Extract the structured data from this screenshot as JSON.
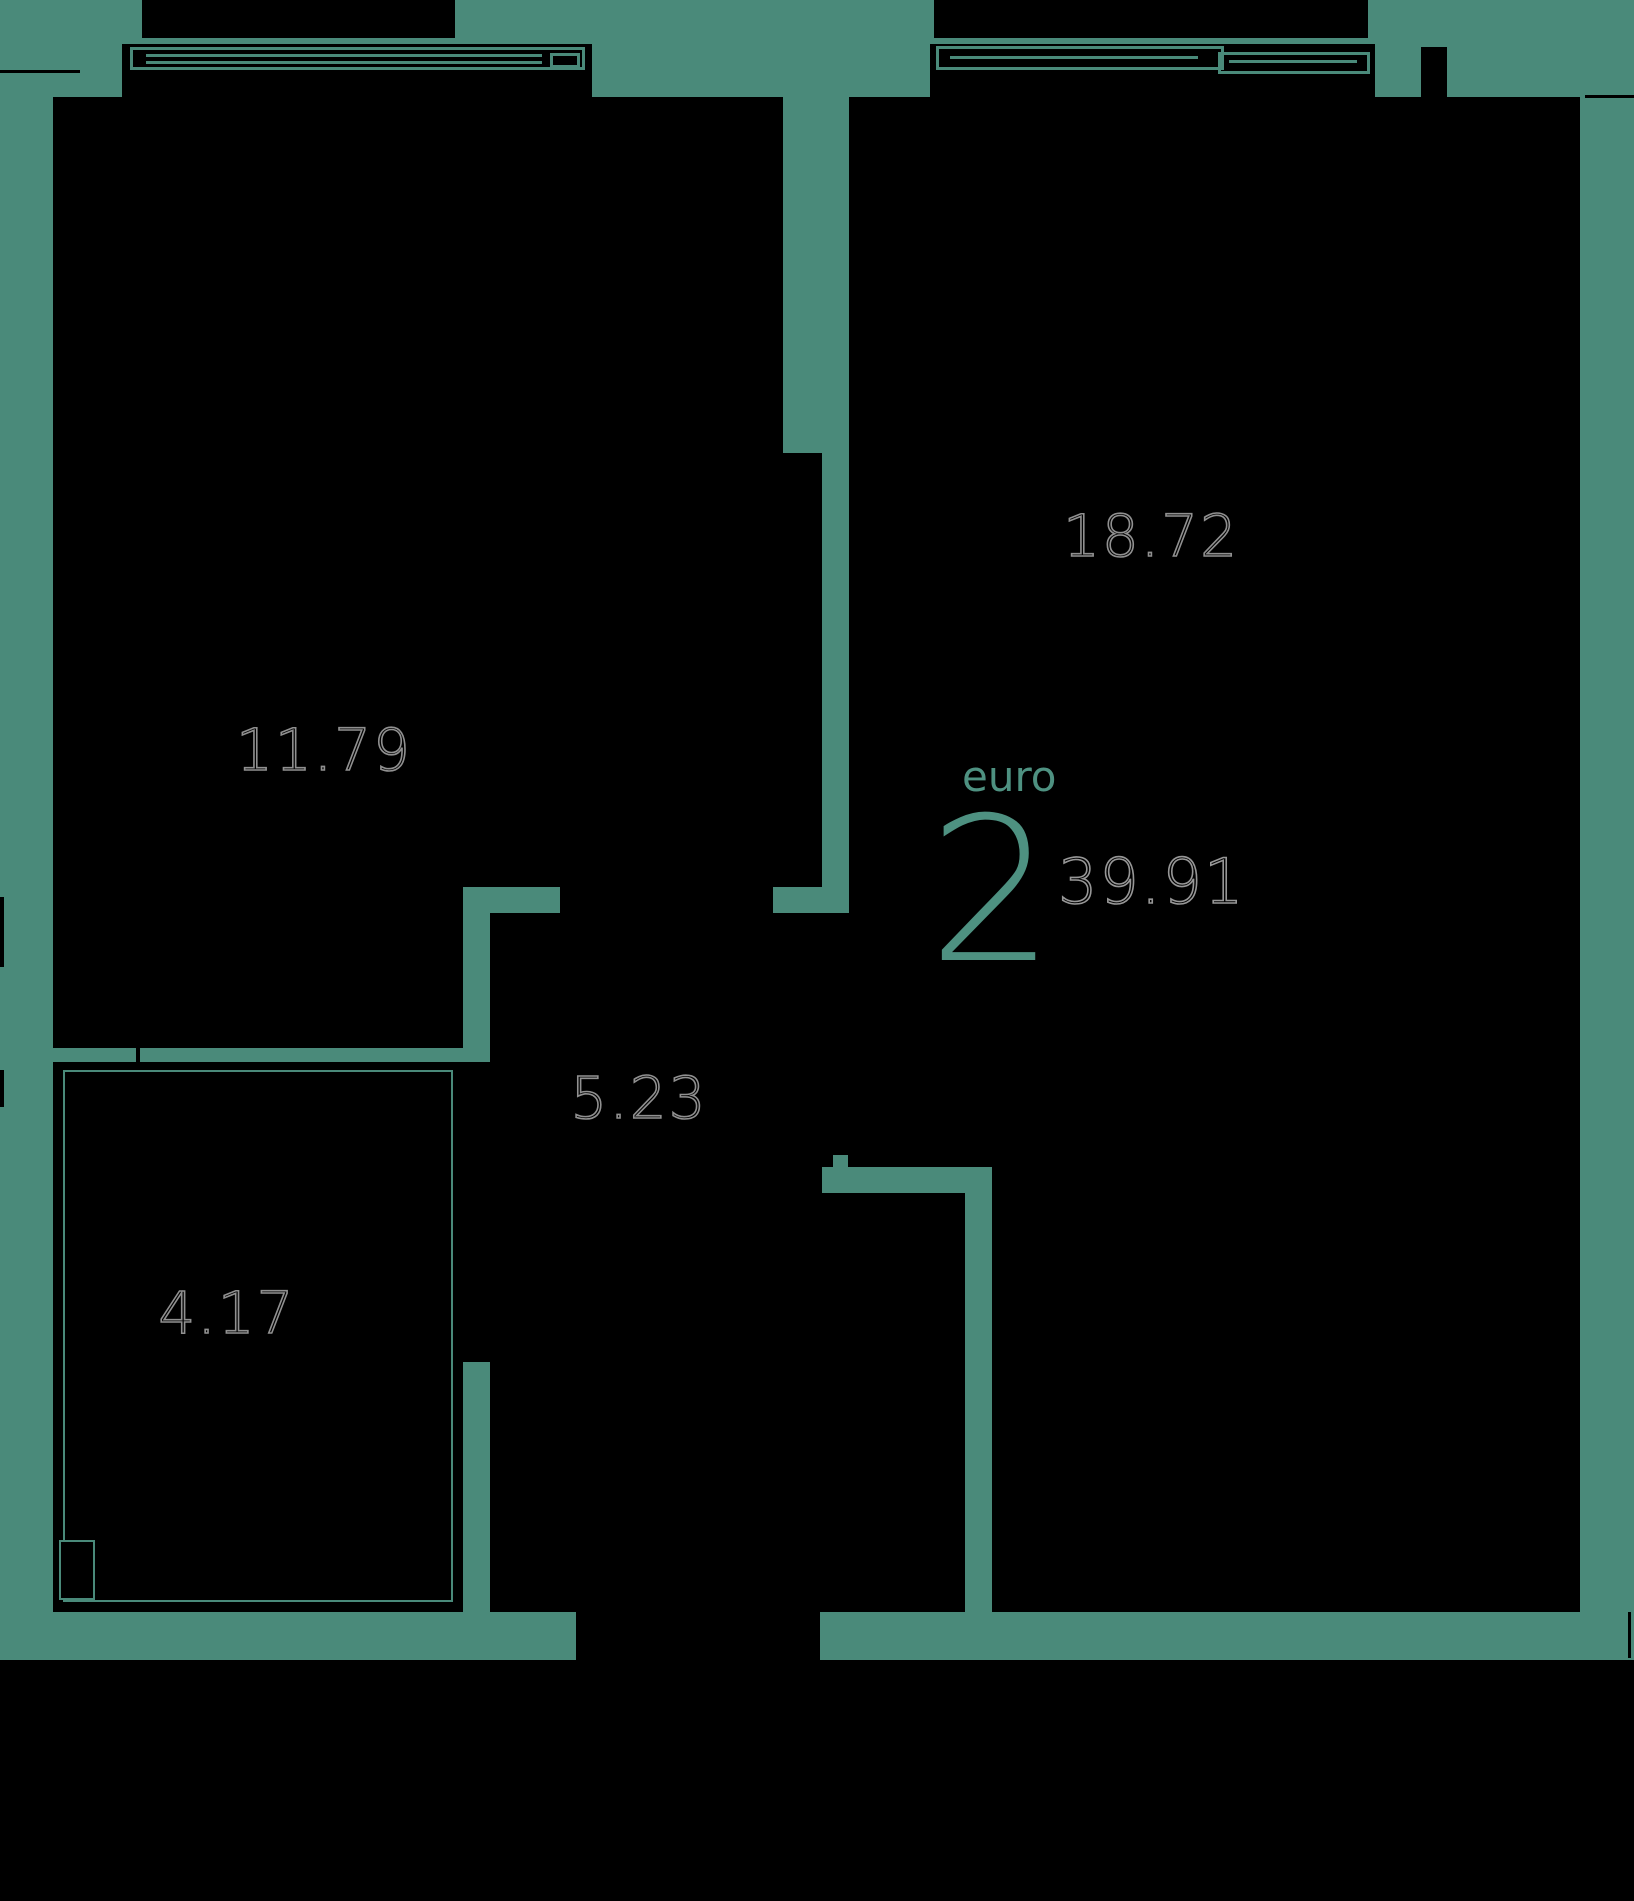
{
  "floor_plan": {
    "unit": {
      "type_label": "euro",
      "rooms_count": "2",
      "total_area": "39.91"
    },
    "rooms": [
      {
        "name": "room-1",
        "area": "11.79"
      },
      {
        "name": "room-2",
        "area": "18.72"
      },
      {
        "name": "hallway",
        "area": "5.23"
      },
      {
        "name": "bathroom",
        "area": "4.17"
      }
    ],
    "colors": {
      "background": "#4a8a7a",
      "walls_fill": "#000000",
      "area_label_outline": "#909090",
      "accent_text": "#4e9181"
    }
  }
}
